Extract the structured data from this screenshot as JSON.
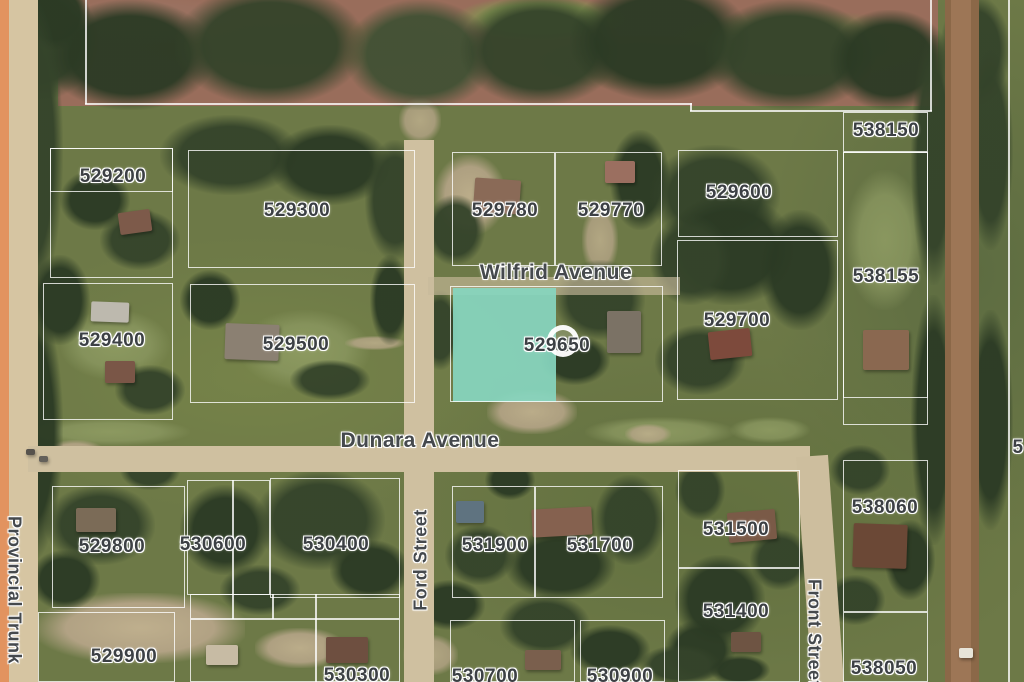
{
  "map": {
    "type": "satellite-parcel-map",
    "colors": {
      "selected_parcel_fill": "#87d5be",
      "parcel_line": "#ffffff",
      "label_text": "#3c4044",
      "highway": "#e2935f",
      "road_tan": "#cfc0a0",
      "dirt_road": "#9d7656"
    },
    "selected_parcel": {
      "label": "529650"
    },
    "parcel_labels": [
      {
        "text": "529200",
        "x": 113,
        "y": 177
      },
      {
        "text": "529300",
        "x": 297,
        "y": 211
      },
      {
        "text": "529780",
        "x": 505,
        "y": 211
      },
      {
        "text": "529770",
        "x": 611,
        "y": 211
      },
      {
        "text": "529600",
        "x": 739,
        "y": 193
      },
      {
        "text": "538150",
        "x": 886,
        "y": 131
      },
      {
        "text": "538155",
        "x": 886,
        "y": 277
      },
      {
        "text": "529400",
        "x": 112,
        "y": 341
      },
      {
        "text": "529500",
        "x": 296,
        "y": 345
      },
      {
        "text": "529650",
        "x": 557,
        "y": 346,
        "selected": true
      },
      {
        "text": "529700",
        "x": 737,
        "y": 321
      },
      {
        "text": "529800",
        "x": 112,
        "y": 547
      },
      {
        "text": "530600",
        "x": 213,
        "y": 545
      },
      {
        "text": "530400",
        "x": 336,
        "y": 545
      },
      {
        "text": "531900",
        "x": 495,
        "y": 546
      },
      {
        "text": "531700",
        "x": 600,
        "y": 546
      },
      {
        "text": "531500",
        "x": 736,
        "y": 530
      },
      {
        "text": "531400",
        "x": 736,
        "y": 612
      },
      {
        "text": "538060",
        "x": 885,
        "y": 508
      },
      {
        "text": "538050",
        "x": 884,
        "y": 669
      },
      {
        "text": "529900",
        "x": 124,
        "y": 657
      },
      {
        "text": "530300",
        "x": 357,
        "y": 676
      },
      {
        "text": "530700",
        "x": 485,
        "y": 677
      },
      {
        "text": "530900",
        "x": 620,
        "y": 677
      },
      {
        "text": "5",
        "x": 1018,
        "y": 448,
        "partial": true
      }
    ],
    "street_labels": [
      {
        "text": "Wilfrid Avenue",
        "x": 556,
        "y": 273,
        "rotate": 0
      },
      {
        "text": "Dunara Avenue",
        "x": 420,
        "y": 441,
        "rotate": 0
      },
      {
        "text": "Ford Street",
        "x": 421,
        "y": 560,
        "rotate": -90
      },
      {
        "text": "Front Street",
        "x": 814,
        "y": 633,
        "rotate": 90
      },
      {
        "text": "Provincial Trunk",
        "x": 14,
        "y": 590,
        "rotate": 90
      }
    ]
  }
}
